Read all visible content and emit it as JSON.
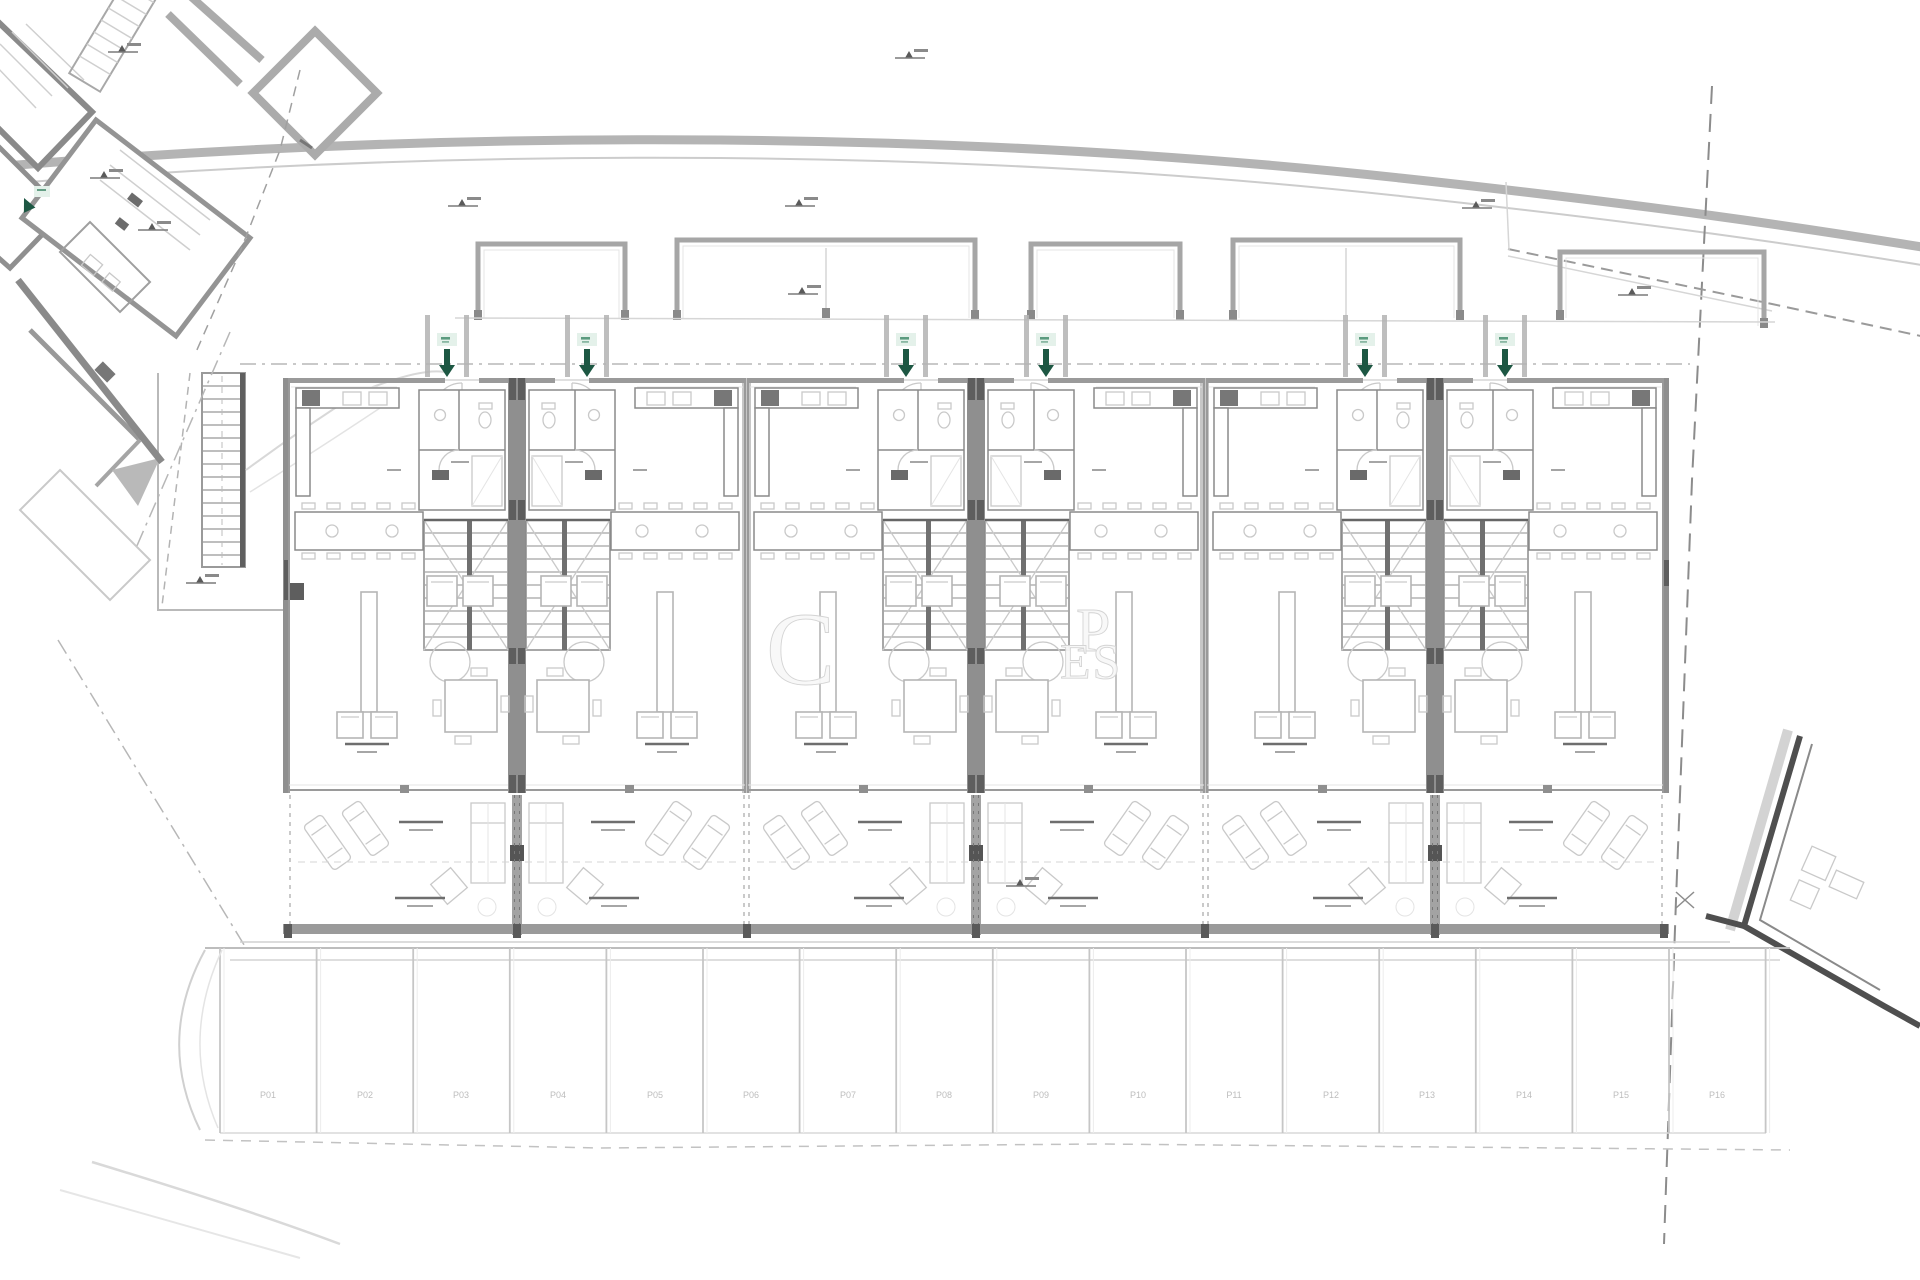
{
  "page": {
    "background": "#ffffff"
  },
  "watermark": {
    "letters": [
      "C",
      "P",
      "ES"
    ]
  },
  "building": {
    "units": 6,
    "entrances": 6,
    "carports": 5,
    "terraces": 6
  },
  "parking": {
    "stalls": [
      {
        "label": "P01"
      },
      {
        "label": "P02"
      },
      {
        "label": "P03"
      },
      {
        "label": "P04"
      },
      {
        "label": "P05"
      },
      {
        "label": "P06"
      },
      {
        "label": "P07"
      },
      {
        "label": "P08"
      },
      {
        "label": "P09"
      },
      {
        "label": "P10"
      },
      {
        "label": "P11"
      },
      {
        "label": "P12"
      },
      {
        "label": "P13"
      },
      {
        "label": "P14"
      },
      {
        "label": "P15"
      },
      {
        "label": "P16"
      }
    ]
  },
  "colors": {
    "wall_gray": "#8f8f8f",
    "wall_dark": "#5e5e5e",
    "line_light": "#d6d6d6",
    "furniture_gray": "#b5b5b5",
    "road_gray": "#b4b4b4",
    "boundary_dash": "#8c8c8c",
    "arrow_green": "#1d5743",
    "arrow_halo": "#e4f1ea",
    "watermark_gray": "#ececec",
    "label_gray": "#9a9a9a"
  }
}
